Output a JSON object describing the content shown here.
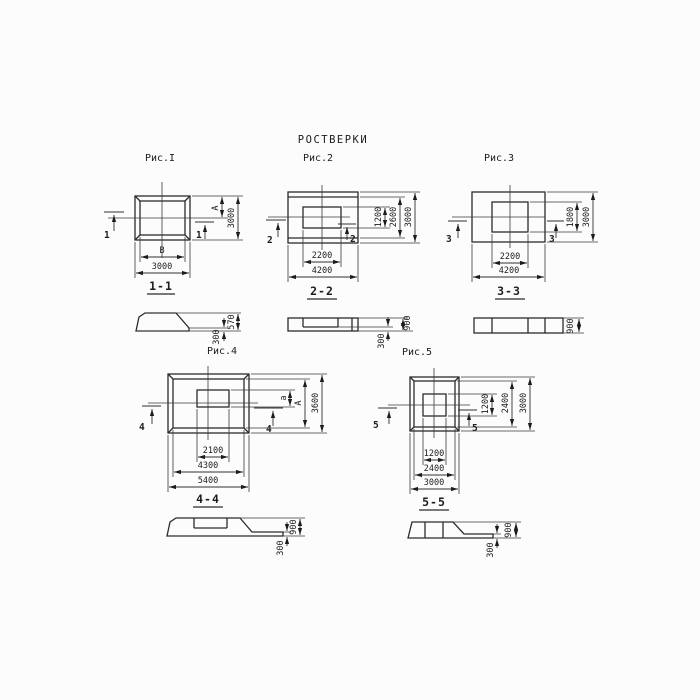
{
  "title": "РОСТВЕРКИ",
  "fig1": {
    "label": "Рис.I",
    "cut": "1",
    "dim_inner_width": "В",
    "dim_outer_width": "3000",
    "dim_inner_height": "А",
    "dim_outer_height": "3000",
    "section_label": "1-1",
    "sec_h_small": "300",
    "sec_h_big": "570"
  },
  "fig2": {
    "label": "Рис.2",
    "cut": "2",
    "dim_inner_width": "2200",
    "dim_outer_width": "4200",
    "dim_inner_height": "1200",
    "dim_mid_height": "2600",
    "dim_outer_height": "3000",
    "section_label": "2-2",
    "sec_h_small": "300",
    "sec_h_big": "900"
  },
  "fig3": {
    "label": "Рис.3",
    "cut": "3",
    "dim_inner_width": "2200",
    "dim_outer_width": "4200",
    "dim_inner_height": "1800",
    "dim_outer_height": "3000",
    "section_label": "3-3",
    "sec_h_big": "900"
  },
  "fig4": {
    "label": "Рис.4",
    "cut": "4",
    "dim_inner_width": "2100",
    "dim_mid_width": "4300",
    "dim_outer_width": "5400",
    "dim_inner_height": "а",
    "dim_mid_height": "А",
    "dim_outer_height": "3600",
    "section_label": "4-4",
    "sec_h_small": "300",
    "sec_h_big": "900"
  },
  "fig5": {
    "label": "Рис.5",
    "cut": "5",
    "dim_inner_width": "1200",
    "dim_mid_width": "2400",
    "dim_outer_width": "3000",
    "dim_inner_height": "1200",
    "dim_mid_height": "2400",
    "dim_outer_height": "3000",
    "section_label": "5-5",
    "sec_h_small": "300",
    "sec_h_big": "900"
  }
}
